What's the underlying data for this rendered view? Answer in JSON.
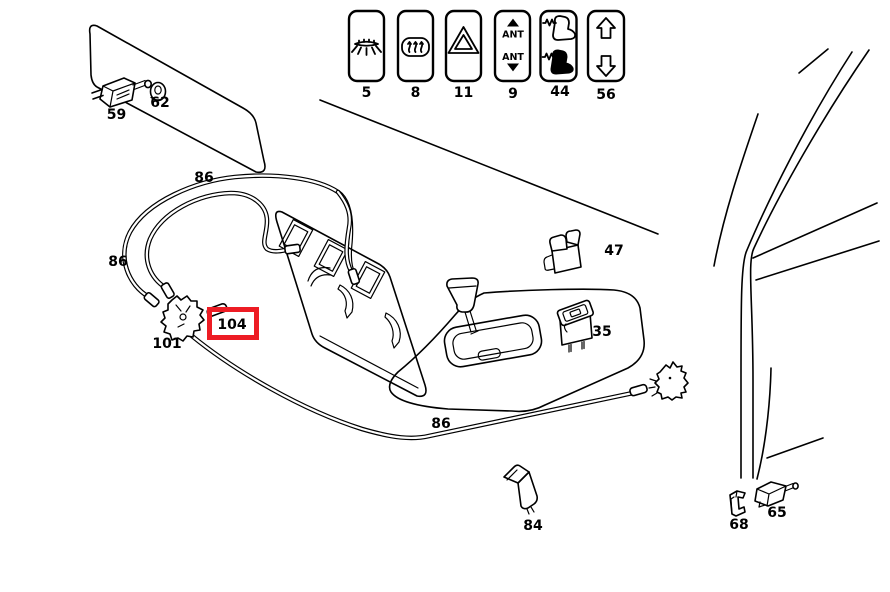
{
  "colors": {
    "background": "#ffffff",
    "line": "#000000",
    "highlight_red": "#ed1c24"
  },
  "switch_buttons": [
    {
      "number": "5",
      "icon": "interior-light-icon"
    },
    {
      "number": "8",
      "icon": "rear-window-defroster-icon"
    },
    {
      "number": "11",
      "icon": "hazard-warning-triangle-icon"
    },
    {
      "number": "9",
      "icon": "antenna-up-down-icon",
      "top_label": "ANT",
      "bottom_label": "ANT"
    },
    {
      "number": "44",
      "icon": "heated-seat-icon"
    },
    {
      "number": "56",
      "icon": "window-lifter-icon"
    }
  ],
  "part_labels": [
    {
      "number": "59"
    },
    {
      "number": "62"
    },
    {
      "number": "86"
    },
    {
      "number": "86"
    },
    {
      "number": "101"
    },
    {
      "number": "104",
      "highlighted": true
    },
    {
      "number": "47"
    },
    {
      "number": "35"
    },
    {
      "number": "86"
    },
    {
      "number": "84"
    },
    {
      "number": "68"
    },
    {
      "number": "65"
    }
  ]
}
